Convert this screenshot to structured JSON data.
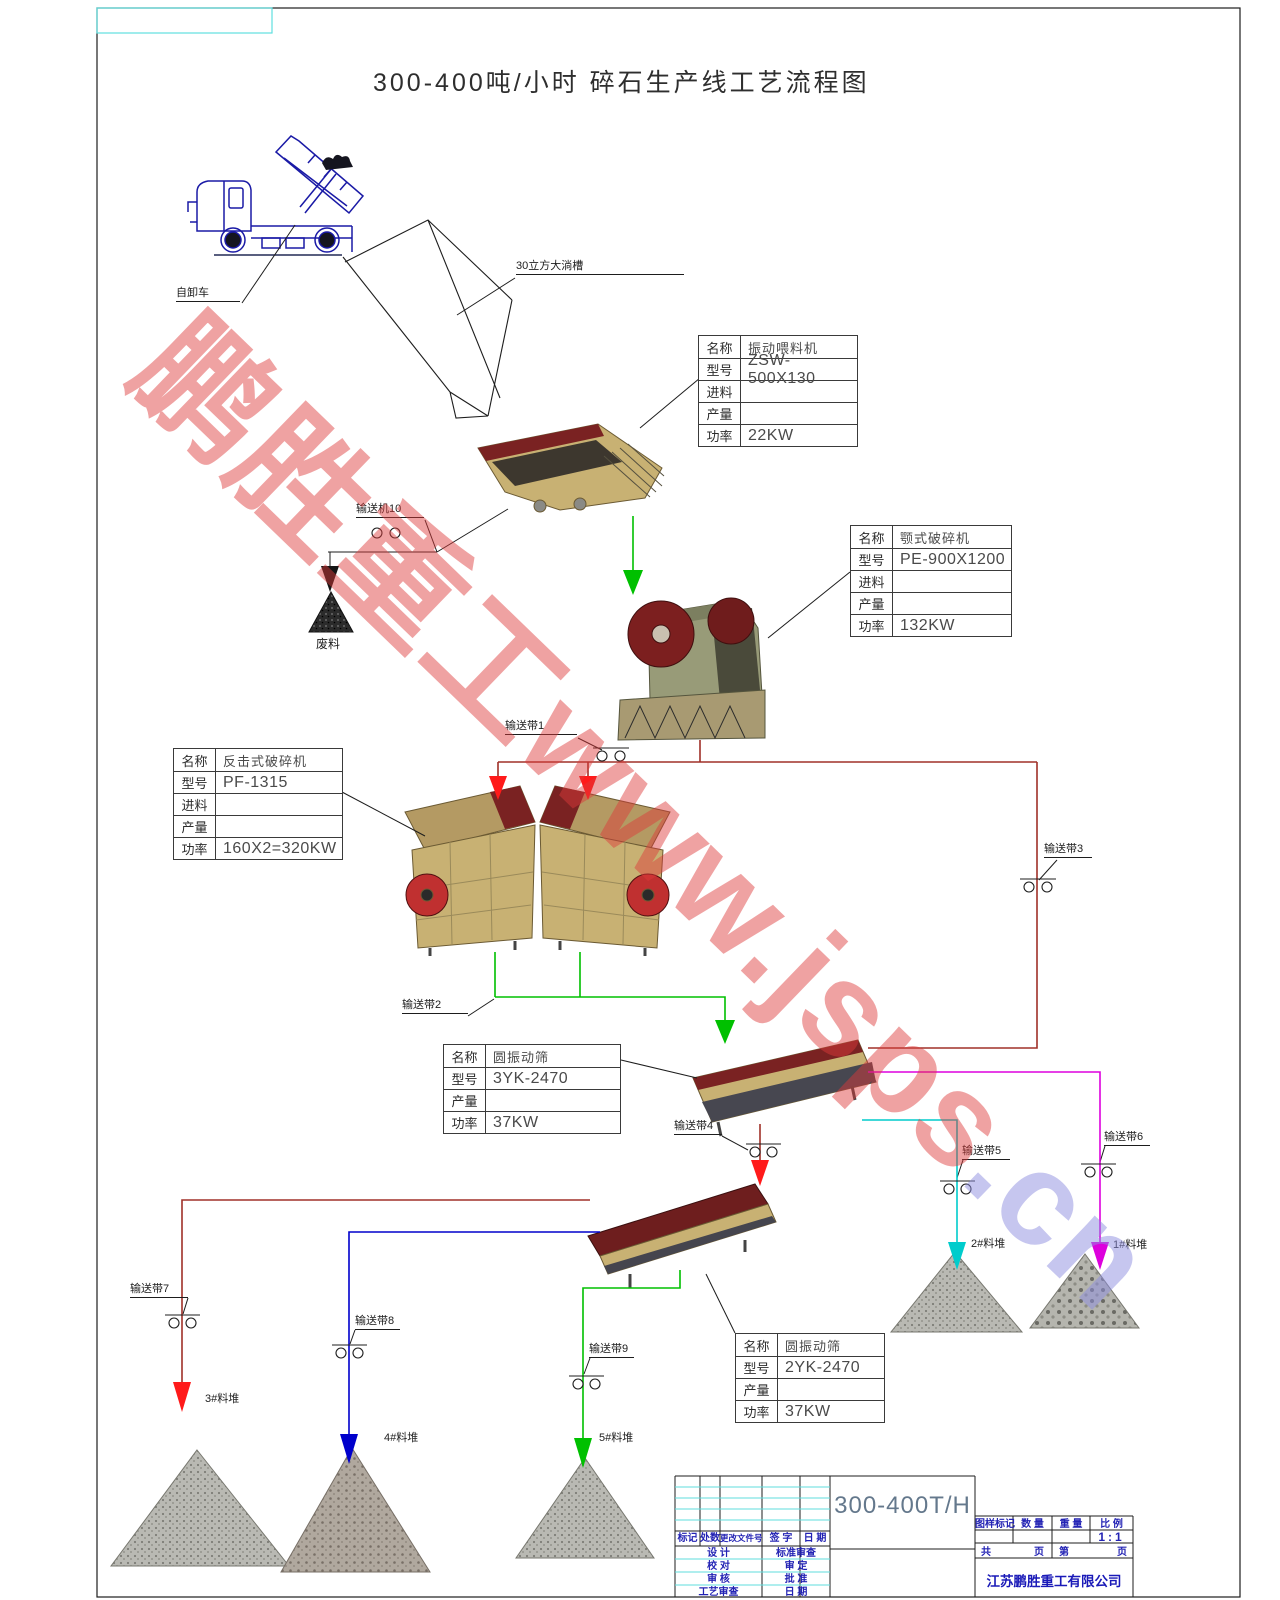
{
  "page_title": "300-400吨/小时  碎石生产线工艺流程图",
  "watermark": {
    "red_text": "鹏胜重工www.jsps",
    "violet_text": ".cn"
  },
  "flow_labels": {
    "dump_truck": "自卸车",
    "hopper": "30立方大淌槽",
    "conveyor_10": "输送机10",
    "waste_pile": "废料",
    "belt_1": "输送带1",
    "belt_2": "输送带2",
    "belt_3": "输送带3",
    "belt_4": "输送带4",
    "belt_5": "输送带5",
    "belt_6": "输送带6",
    "belt_7": "输送带7",
    "belt_8": "输送带8",
    "belt_9": "输送带9",
    "pile_1": "1#料堆",
    "pile_2": "2#料堆",
    "pile_3": "3#料堆",
    "pile_4": "4#料堆",
    "pile_5": "5#料堆"
  },
  "spec_tables": [
    {
      "machine": "vibrating-feeder",
      "rows": [
        [
          "名称",
          "振动喂料机"
        ],
        [
          "型号",
          "ZSW-500X130"
        ],
        [
          "进料",
          ""
        ],
        [
          "产量",
          ""
        ],
        [
          "功率",
          "22KW"
        ]
      ]
    },
    {
      "machine": "jaw-crusher",
      "rows": [
        [
          "名称",
          "颚式破碎机"
        ],
        [
          "型号",
          "PE-900X1200"
        ],
        [
          "进料",
          ""
        ],
        [
          "产量",
          ""
        ],
        [
          "功率",
          "132KW"
        ]
      ]
    },
    {
      "machine": "impact-crusher",
      "rows": [
        [
          "名称",
          "反击式破碎机"
        ],
        [
          "型号",
          "PF-1315"
        ],
        [
          "进料",
          ""
        ],
        [
          "产量",
          ""
        ],
        [
          "功率",
          "160X2=320KW"
        ]
      ]
    },
    {
      "machine": "circular-vibrating-screen-1",
      "rows": [
        [
          "名称",
          "圆振动筛"
        ],
        [
          "型号",
          "3YK-2470"
        ],
        [
          "产量",
          ""
        ],
        [
          "功率",
          "37KW"
        ]
      ]
    },
    {
      "machine": "circular-vibrating-screen-2",
      "rows": [
        [
          "名称",
          "圆振动筛"
        ],
        [
          "型号",
          "2YK-2470"
        ],
        [
          "产量",
          ""
        ],
        [
          "功率",
          "37KW"
        ]
      ]
    }
  ],
  "title_block": {
    "drawing_code": "300-400T/H",
    "scale_value": "1:1",
    "company": "江苏鹏胜重工有限公司",
    "rev_headers": [
      "标记",
      "处数",
      "更改文件号",
      "签 字",
      "日 期"
    ],
    "right_headers": [
      "图样标记",
      "数 量",
      "重 量",
      "比 例"
    ],
    "pages": [
      "共",
      "页",
      "第",
      "页"
    ],
    "roles_left": [
      "设 计",
      "校 对",
      "审 核",
      "工艺审查"
    ],
    "roles_right": [
      "标准审查",
      "审 定",
      "批 准",
      "日 期"
    ]
  },
  "colors": {
    "cad_black": "#1d1d1d",
    "truck_blue": "#1a1aa6",
    "flow_green": "#00c000",
    "flow_dark_red": "#a03028",
    "arrow_red": "#ff1a1a",
    "flow_cyan": "#00cccc",
    "flow_magenta": "#dd00dd",
    "flow_blue": "#0000cc",
    "frame_cyan": "#5fdede",
    "title_block_blue": "#2323b4",
    "drawing_code_gray_blue": "#64788c",
    "watermark_red": "rgba(222,58,58,0.47)",
    "watermark_violet": "rgba(142,142,224,0.5)",
    "machine_tan": "#c8b173",
    "machine_dark_red": "#7a2222"
  }
}
